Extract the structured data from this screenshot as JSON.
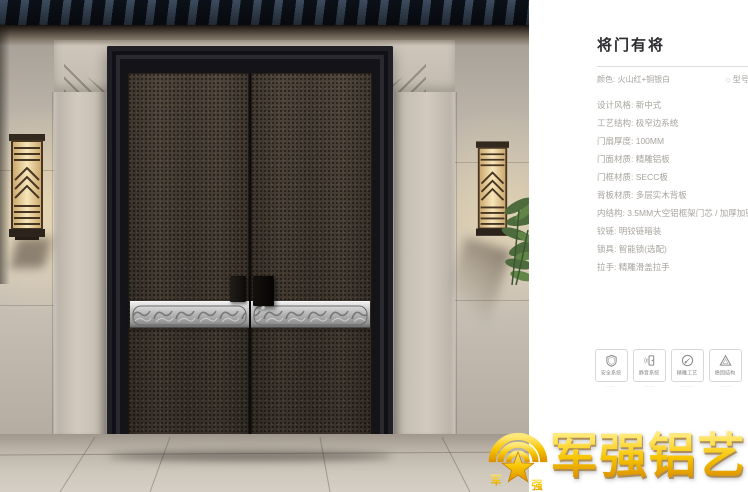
{
  "product_panel": {
    "title": "将门有将",
    "color_label": "颜色: 火山红+铜银白",
    "model_icon_glyph": "◇",
    "model_label": "型号: JC",
    "specs": [
      "设计风格: 新中式",
      "工艺结构: 极窄边系统",
      "门扇厚度: 100MM",
      "门面材质: 精雕铝板",
      "门框材质: SECC板",
      "背板材质: 多层实木背板",
      "内结构: 3.5MM大空铝框架门芯 / 加厚加密航空铝管",
      "铰链: 明铰链暗装",
      "锁具: 智能锁(选配)",
      "拉手: 精雕滑盖拉手"
    ],
    "features": [
      {
        "icon": "shield-icon",
        "label": "安全系统",
        "caption": "·········"
      },
      {
        "icon": "soundproof-door-icon",
        "label": "静音系统",
        "caption": "··········"
      },
      {
        "icon": "engraving-pen-icon",
        "label": "精雕工艺",
        "caption": "···········"
      },
      {
        "icon": "stability-triangle-icon",
        "label": "稳固结构",
        "caption": "··········"
      }
    ]
  },
  "brand_logo": {
    "name": "军强铝艺",
    "emblem_char_left": "军",
    "emblem_char_right": "强"
  },
  "colors": {
    "brand_gold": "#F6C500",
    "door_bronze": "#463C33",
    "band_silver": "#C9C9C9",
    "wall_gray": "#BDB5AA",
    "panel_background": "#FFFFFF",
    "spec_text": "#A8A49E",
    "title_text": "#2B2B30"
  }
}
